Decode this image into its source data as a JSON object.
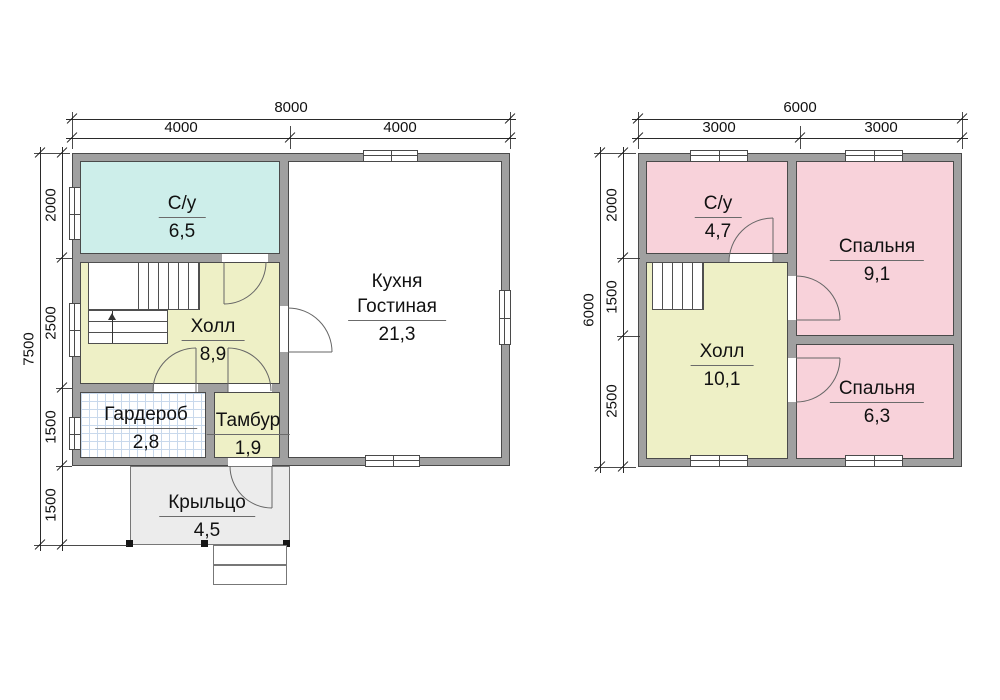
{
  "colors": {
    "wall_fill": "#a0a0a0",
    "wall_outline": "#4a4a4a",
    "wc_cyan": "#cdeeea",
    "hall_yellow": "#eef0c6",
    "bedroom_pink": "#f8d2da",
    "wardrobe_grid": "#c9d9ec",
    "porch_gray": "#ececec"
  },
  "floor1": {
    "dim_top_total": "8000",
    "dim_top_segments": [
      "4000",
      "4000"
    ],
    "dim_left_total": "7500",
    "dim_left_segments": [
      "2000",
      "2500",
      "1500",
      "1500"
    ],
    "rooms": {
      "wc": {
        "name": "С/у",
        "area": "6,5"
      },
      "kitchen": {
        "name_line1": "Кухня",
        "name_line2": "Гостиная",
        "area": "21,3"
      },
      "hall": {
        "name": "Холл",
        "area": "8,9"
      },
      "wardrobe": {
        "name": "Гардероб",
        "area": "2,8"
      },
      "tambour": {
        "name": "Тамбур",
        "area": "1,9"
      },
      "porch": {
        "name": "Крыльцо",
        "area": "4,5"
      }
    }
  },
  "floor2": {
    "dim_top_total": "6000",
    "dim_top_segments": [
      "3000",
      "3000"
    ],
    "dim_left_total": "6000",
    "dim_left_segments": [
      "2000",
      "1500",
      "2500"
    ],
    "rooms": {
      "wc": {
        "name": "С/у",
        "area": "4,7"
      },
      "bedroom1": {
        "name": "Спальня",
        "area": "9,1"
      },
      "hall": {
        "name": "Холл",
        "area": "10,1"
      },
      "bedroom2": {
        "name": "Спальня",
        "area": "6,3"
      }
    }
  }
}
